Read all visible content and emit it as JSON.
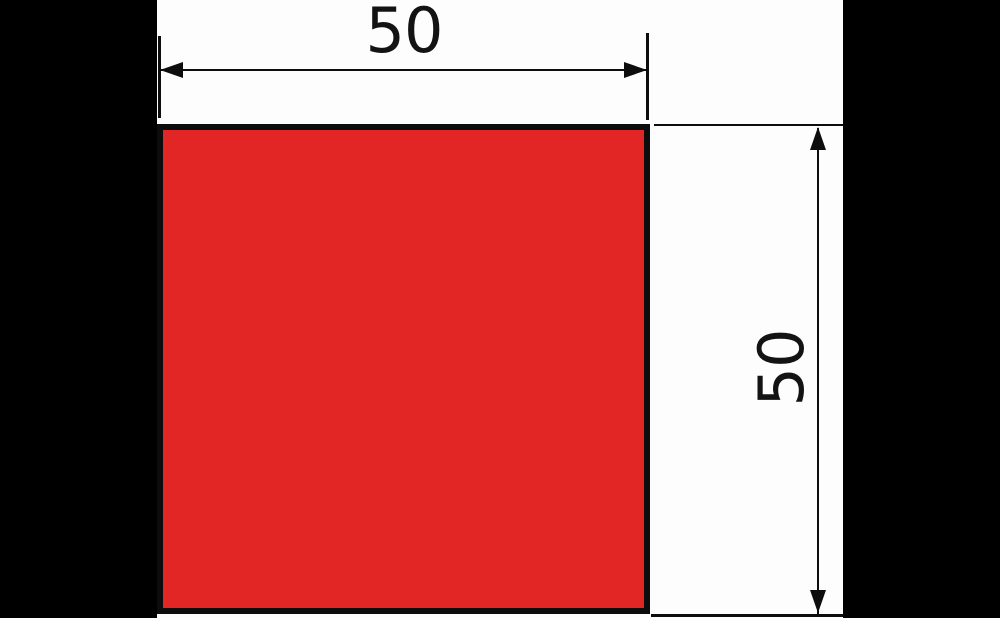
{
  "figure": {
    "type": "technical-drawing",
    "shape": "square",
    "colors": {
      "square_fill": "#e22626",
      "square_outline": "#0c0c0c",
      "dimension_lines": "#0d0d0d",
      "canvas_background": "#fdfdfd",
      "letterbox": "#000000"
    },
    "dimensions": {
      "width": {
        "value": "50"
      },
      "height": {
        "value": "50"
      }
    }
  }
}
